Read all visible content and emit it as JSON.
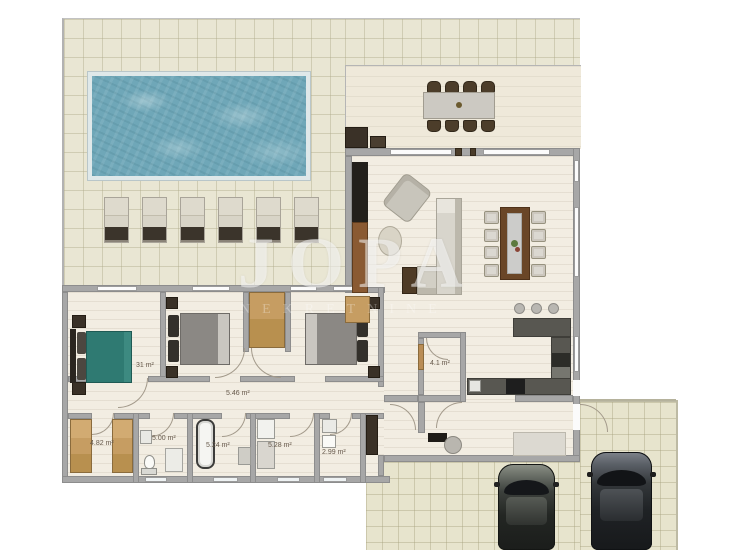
{
  "watermark": {
    "main": "JOPA",
    "sub": "NEKRETNINE"
  },
  "labels": {
    "bedroom1": "31 m²",
    "hallway": "5.46 m²",
    "closet": "4.82 m²",
    "wc": "5.00 m²",
    "bathroom1": "5.24 m²",
    "bathroom2": "5.28 m²",
    "laundry": "2.99 m²",
    "pantry": "4.1 m²"
  },
  "furniture_counts": {
    "sun_loungers": 6,
    "terrace_dining_chairs": 8,
    "indoor_dining_chairs": 8,
    "bar_stools": 3,
    "beds": 3,
    "cars": 2
  },
  "colors": {
    "pool_water": "#6fa7b8",
    "terrace_tile": "#e9e6d3",
    "driveway_tile": "#e7e4cd",
    "interior_floor": "#f2ede2",
    "wall": "#a7a7a7",
    "teal_bed": "#2f7a72",
    "wood_wardrobe": "#c69d62",
    "dark_furniture": "#3a3127",
    "kitchen_counter": "#585751"
  }
}
